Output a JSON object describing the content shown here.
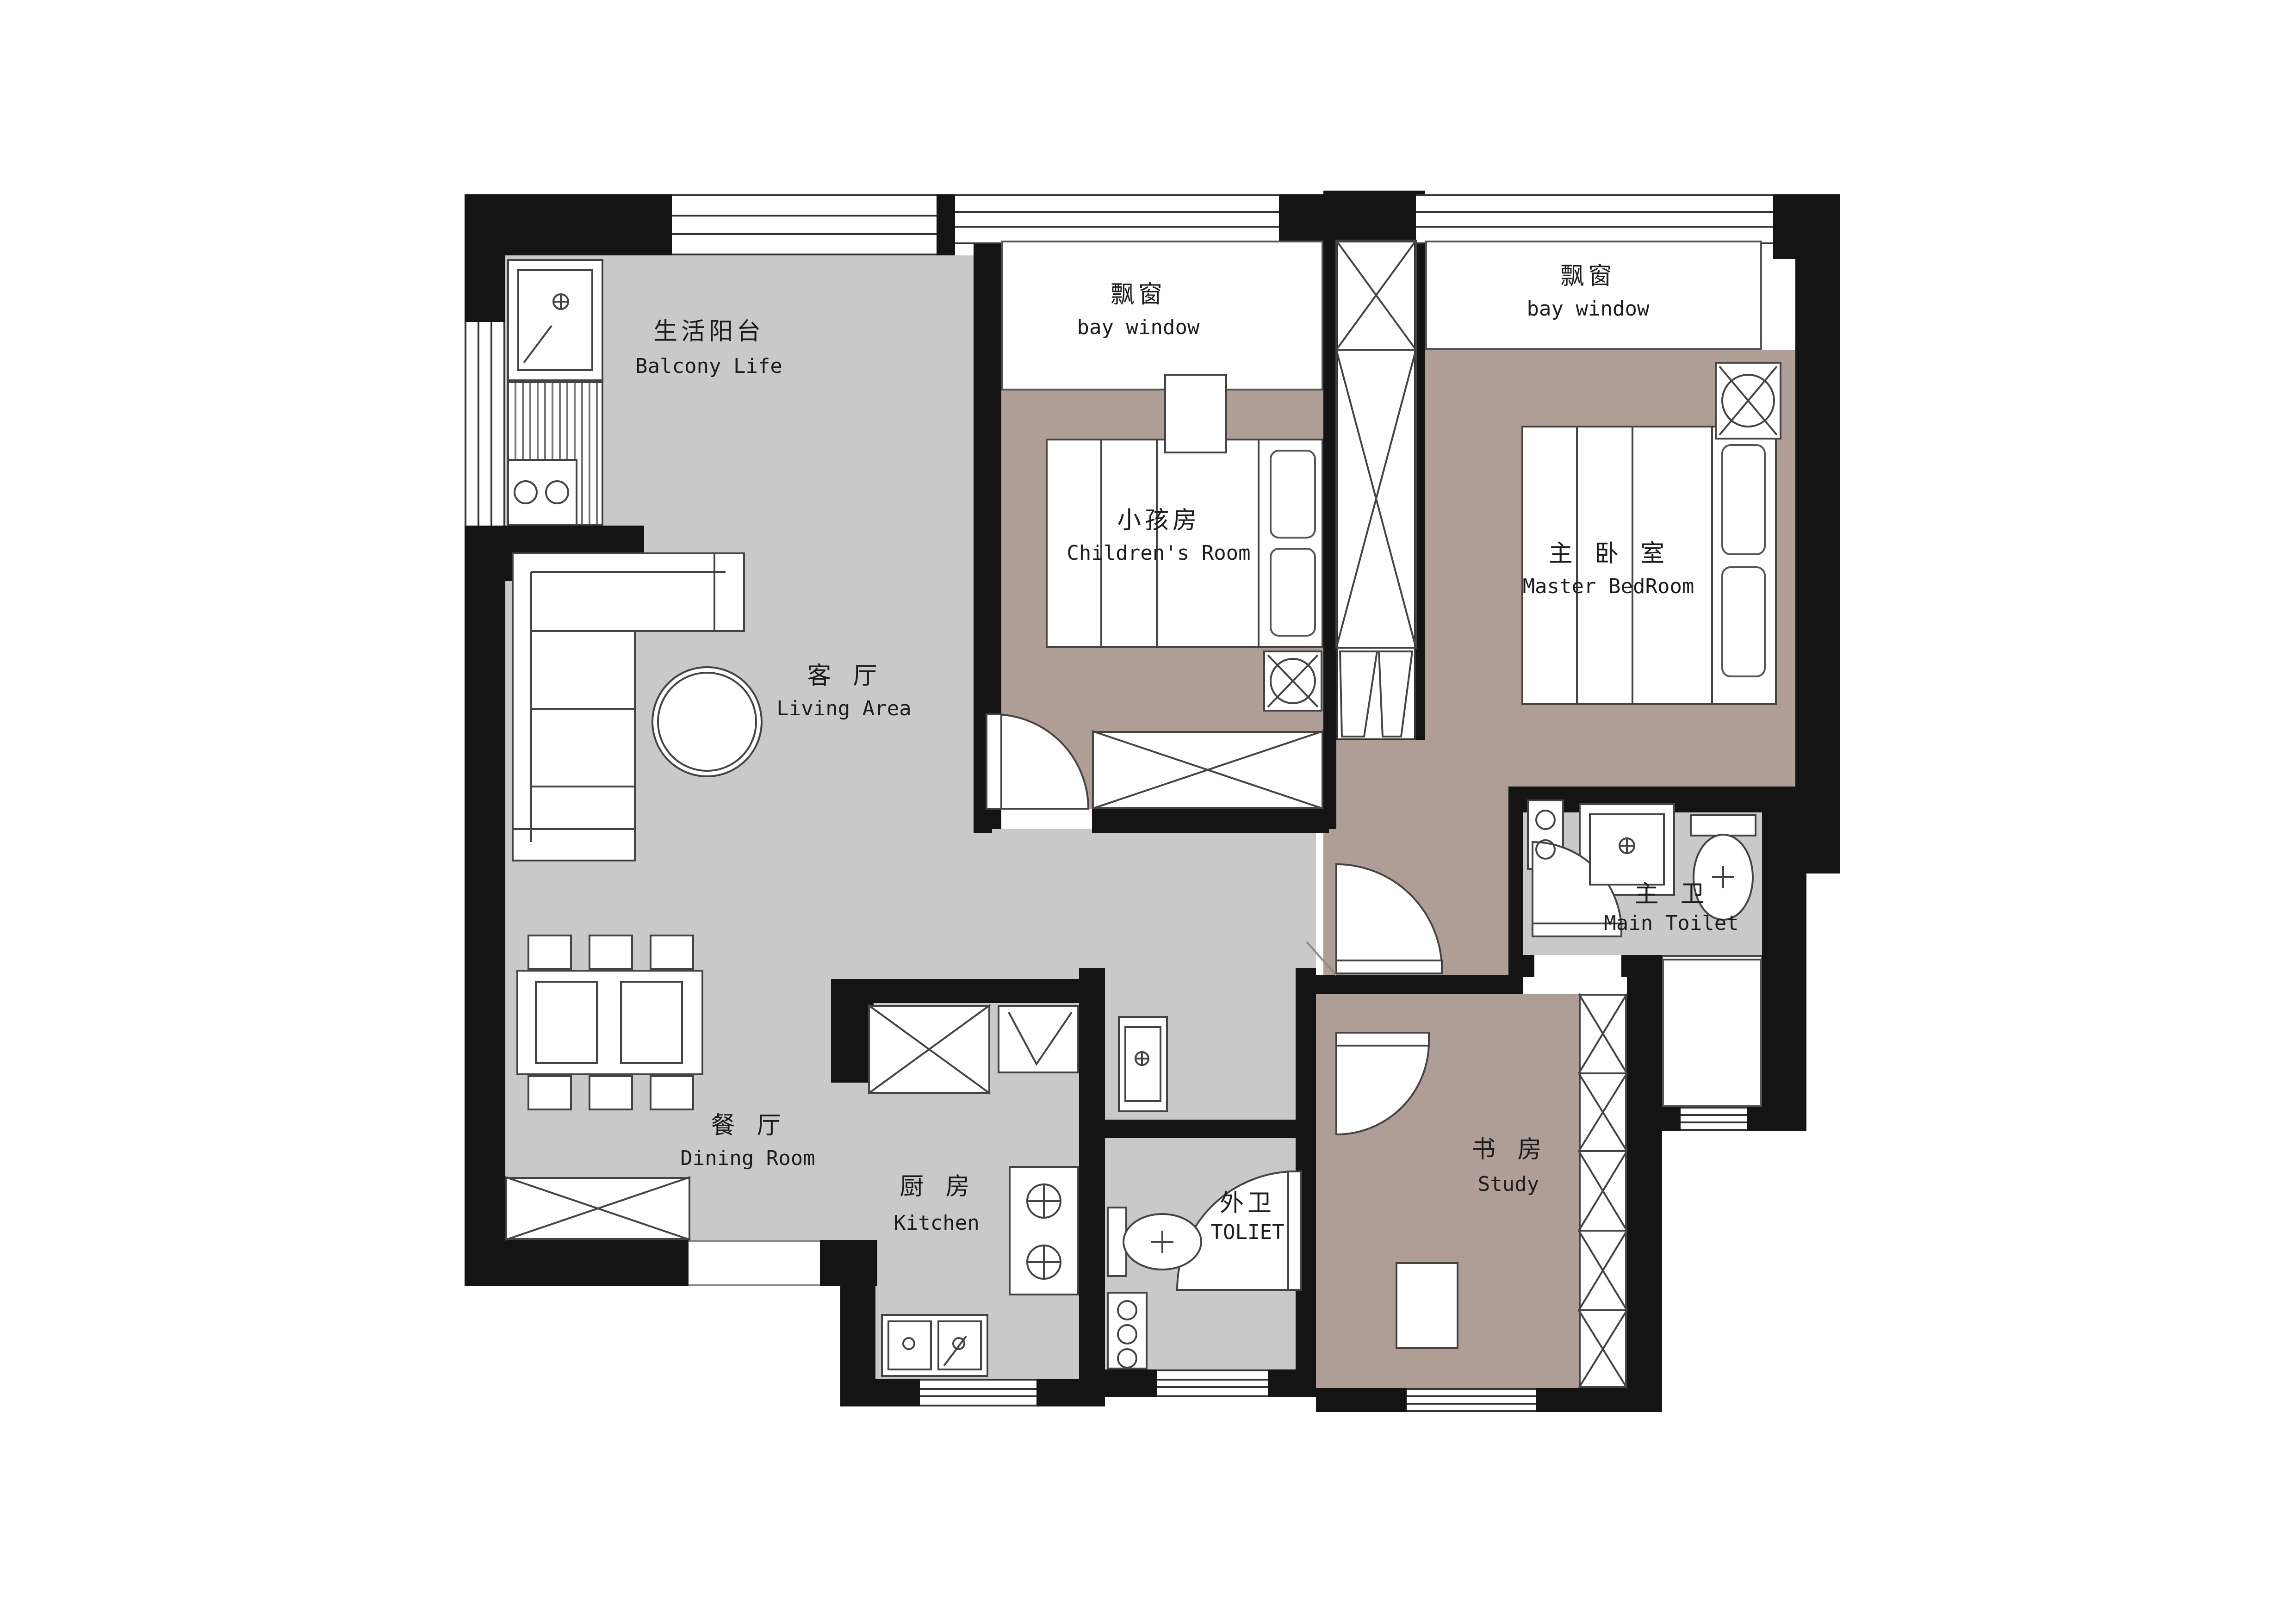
{
  "plan": {
    "colors": {
      "wall": "#141414",
      "floor_gray": "#c9c9c9",
      "floor_brown": "#ae9e96",
      "line": "#444444",
      "background": "#ffffff"
    },
    "rooms": {
      "balcony": {
        "zh": "生活阳台",
        "en": "Balcony Life"
      },
      "bay_window_children": {
        "zh": "飘窗",
        "en": "bay window"
      },
      "bay_window_master": {
        "zh": "飘窗",
        "en": "bay window"
      },
      "children_room": {
        "zh": "小孩房",
        "en": "Children's Room"
      },
      "master_bedroom": {
        "zh": "主 卧 室",
        "en": "Master BedRoom"
      },
      "living_area": {
        "zh": "客 厅",
        "en": "Living Area"
      },
      "dining_room": {
        "zh": "餐 厅",
        "en": "Dining Room"
      },
      "kitchen": {
        "zh": "厨 房",
        "en": "Kitchen"
      },
      "outer_toilet": {
        "zh": "外卫",
        "en": "TOLIET"
      },
      "study": {
        "zh": "书 房",
        "en": "Study"
      },
      "main_toilet": {
        "zh": "主 卫",
        "en": "Main Toilet"
      }
    }
  }
}
